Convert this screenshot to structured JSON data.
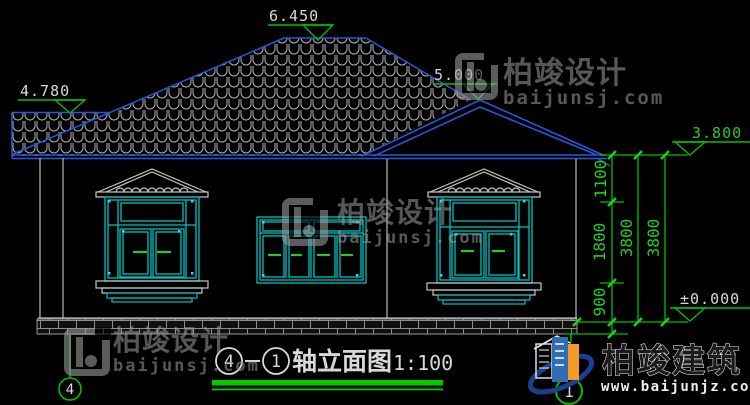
{
  "drawing": {
    "title": {
      "axis_start": "4",
      "axis_end": "1",
      "name": "轴立面图",
      "scale": "1:100"
    },
    "levels": {
      "ridge": "6.450",
      "porch_top": "4.780",
      "gable_peak": "5.000",
      "eave": "3.800",
      "ground": "±0.000"
    },
    "dimensions": {
      "upper": "1100",
      "middle": "1800",
      "lower": "900",
      "total_left": "3800",
      "total_right": "3800"
    },
    "axis_bubbles": {
      "left": "4",
      "right": "1"
    }
  },
  "watermark": {
    "brand": "柏竣设计",
    "site": "baijunsj.com"
  },
  "footer_logo": {
    "brand": "柏竣建筑",
    "site": "www.baijunjz.com"
  },
  "colors": {
    "background": "#000000",
    "cad_blue": "#2857d8",
    "cad_cyan": "#00c2c2",
    "cad_green": "#00bf00",
    "cad_line_white": "#c8c8c8",
    "watermark_gray": "#9a9a9a",
    "logo_blue": "#2f6db5",
    "logo_orange": "#f59b25"
  }
}
